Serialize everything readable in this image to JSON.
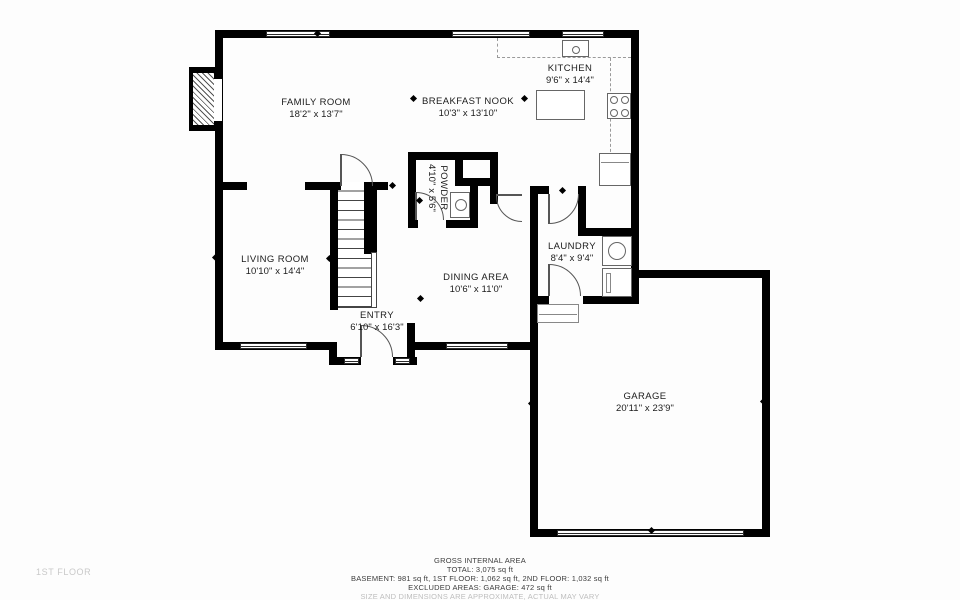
{
  "page": {
    "background": "#fdfdfd",
    "wall_color": "#000000"
  },
  "floor_label": "1ST FLOOR",
  "rooms": [
    {
      "id": "family-room",
      "name": "FAMILY ROOM",
      "dims": "18'2\" x 13'7\""
    },
    {
      "id": "breakfast-nook",
      "name": "BREAKFAST NOOK",
      "dims": "10'3\" x 13'10\""
    },
    {
      "id": "kitchen",
      "name": "KITCHEN",
      "dims": "9'6\" x 14'4\""
    },
    {
      "id": "living-room",
      "name": "LIVING ROOM",
      "dims": "10'10\" x 14'4\""
    },
    {
      "id": "powder",
      "name": "POWDER",
      "dims": "4'10\" x 5'6\""
    },
    {
      "id": "dining-area",
      "name": "DINING AREA",
      "dims": "10'6\" x 11'0\""
    },
    {
      "id": "entry",
      "name": "ENTRY",
      "dims": "6'10\" x 16'3\""
    },
    {
      "id": "laundry",
      "name": "LAUNDRY",
      "dims": "8'4\" x 9'4\""
    },
    {
      "id": "garage",
      "name": "GARAGE",
      "dims": "20'11\" x 23'9\""
    }
  ],
  "footer": {
    "line1": "GROSS INTERNAL AREA",
    "line2": "TOTAL: 3,075 sq ft",
    "line3": "BASEMENT: 981 sq ft, 1ST FLOOR: 1,062 sq ft, 2ND FLOOR: 1,032 sq ft",
    "line4": "EXCLUDED AREAS: GARAGE: 472 sq ft",
    "disclaimer": "SIZE AND DIMENSIONS ARE APPROXIMATE, ACTUAL MAY VARY"
  }
}
